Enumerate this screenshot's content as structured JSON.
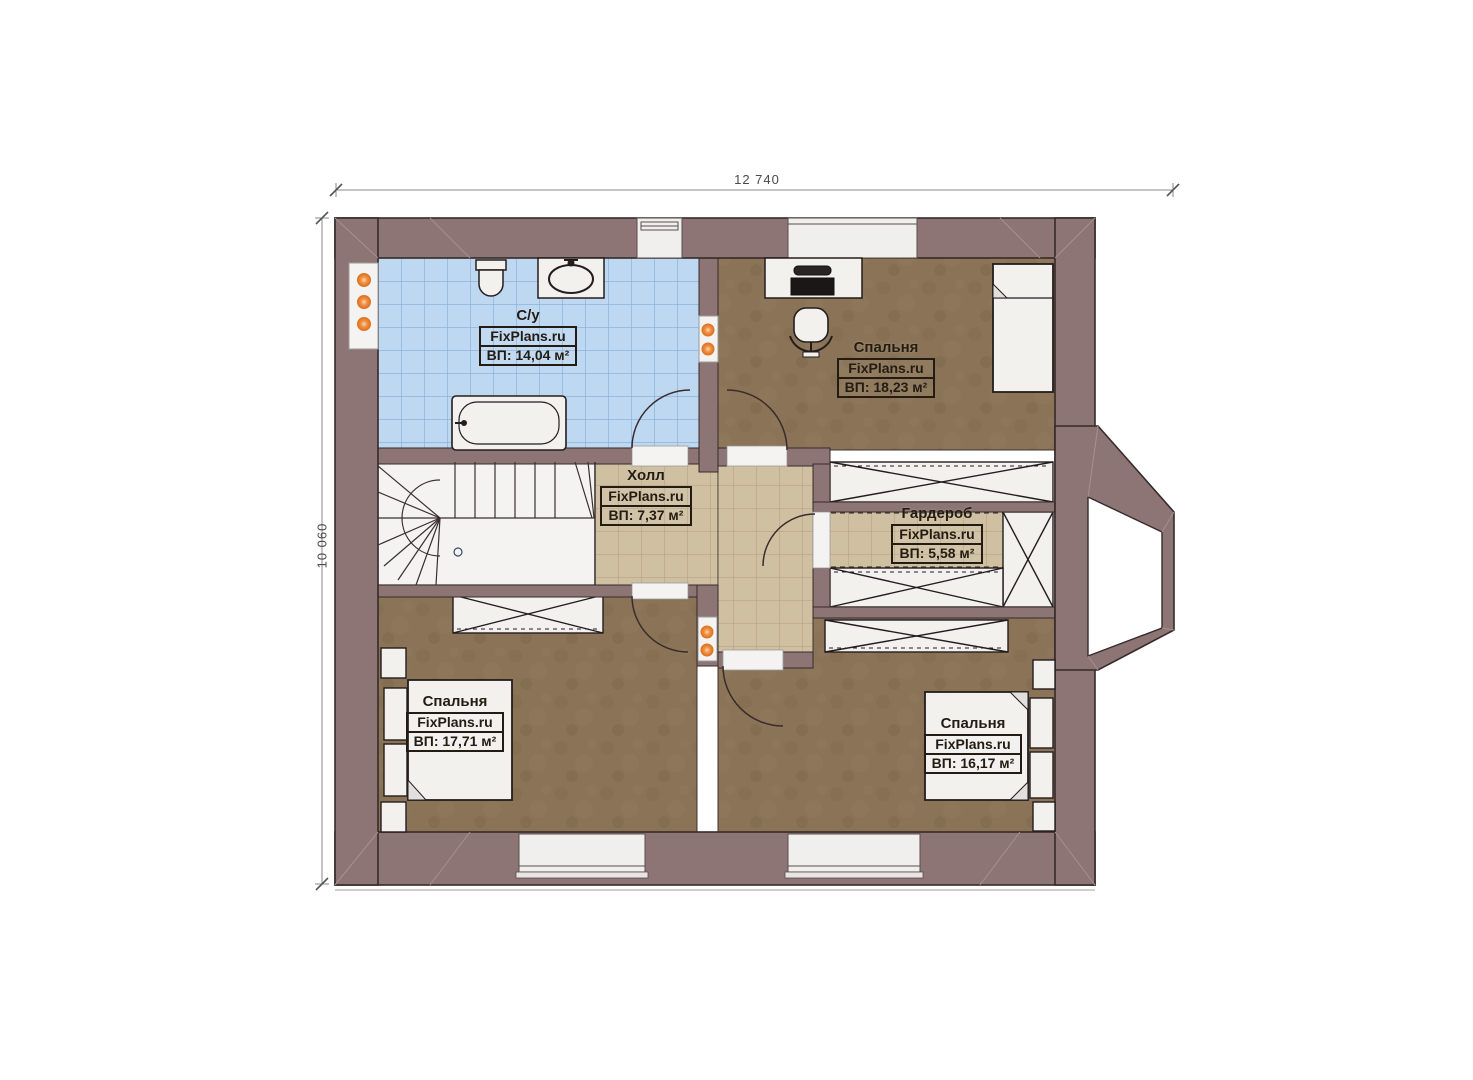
{
  "dimensions": {
    "width_label": "12 740",
    "height_label": "10 060"
  },
  "rooms": [
    {
      "key": "bathroom",
      "name": "С/у",
      "source": "FixPlans.ru",
      "area": "ВП: 14,04 м²"
    },
    {
      "key": "bedroom-top-right",
      "name": "Спальня",
      "source": "FixPlans.ru",
      "area": "ВП: 18,23 м²"
    },
    {
      "key": "hall",
      "name": "Холл",
      "source": "FixPlans.ru",
      "area": "ВП: 7,37 м²"
    },
    {
      "key": "wardrobe",
      "name": "Гардероб",
      "source": "FixPlans.ru",
      "area": "ВП: 5,58 м²"
    },
    {
      "key": "bedroom-bottom-left",
      "name": "Спальня",
      "source": "FixPlans.ru",
      "area": "ВП: 17,71 м²"
    },
    {
      "key": "bedroom-bottom-right",
      "name": "Спальня",
      "source": "FixPlans.ru",
      "area": "ВП: 16,17 м²"
    }
  ],
  "colors": {
    "wall": "#8d7575",
    "wall_outline": "#372a2a",
    "bathroom_floor": "#bed8f2",
    "tile_floor": "#cfc0a2",
    "carpet": "#8a7356",
    "furniture": "#f2f1ee",
    "light_point": "#e8812f"
  }
}
